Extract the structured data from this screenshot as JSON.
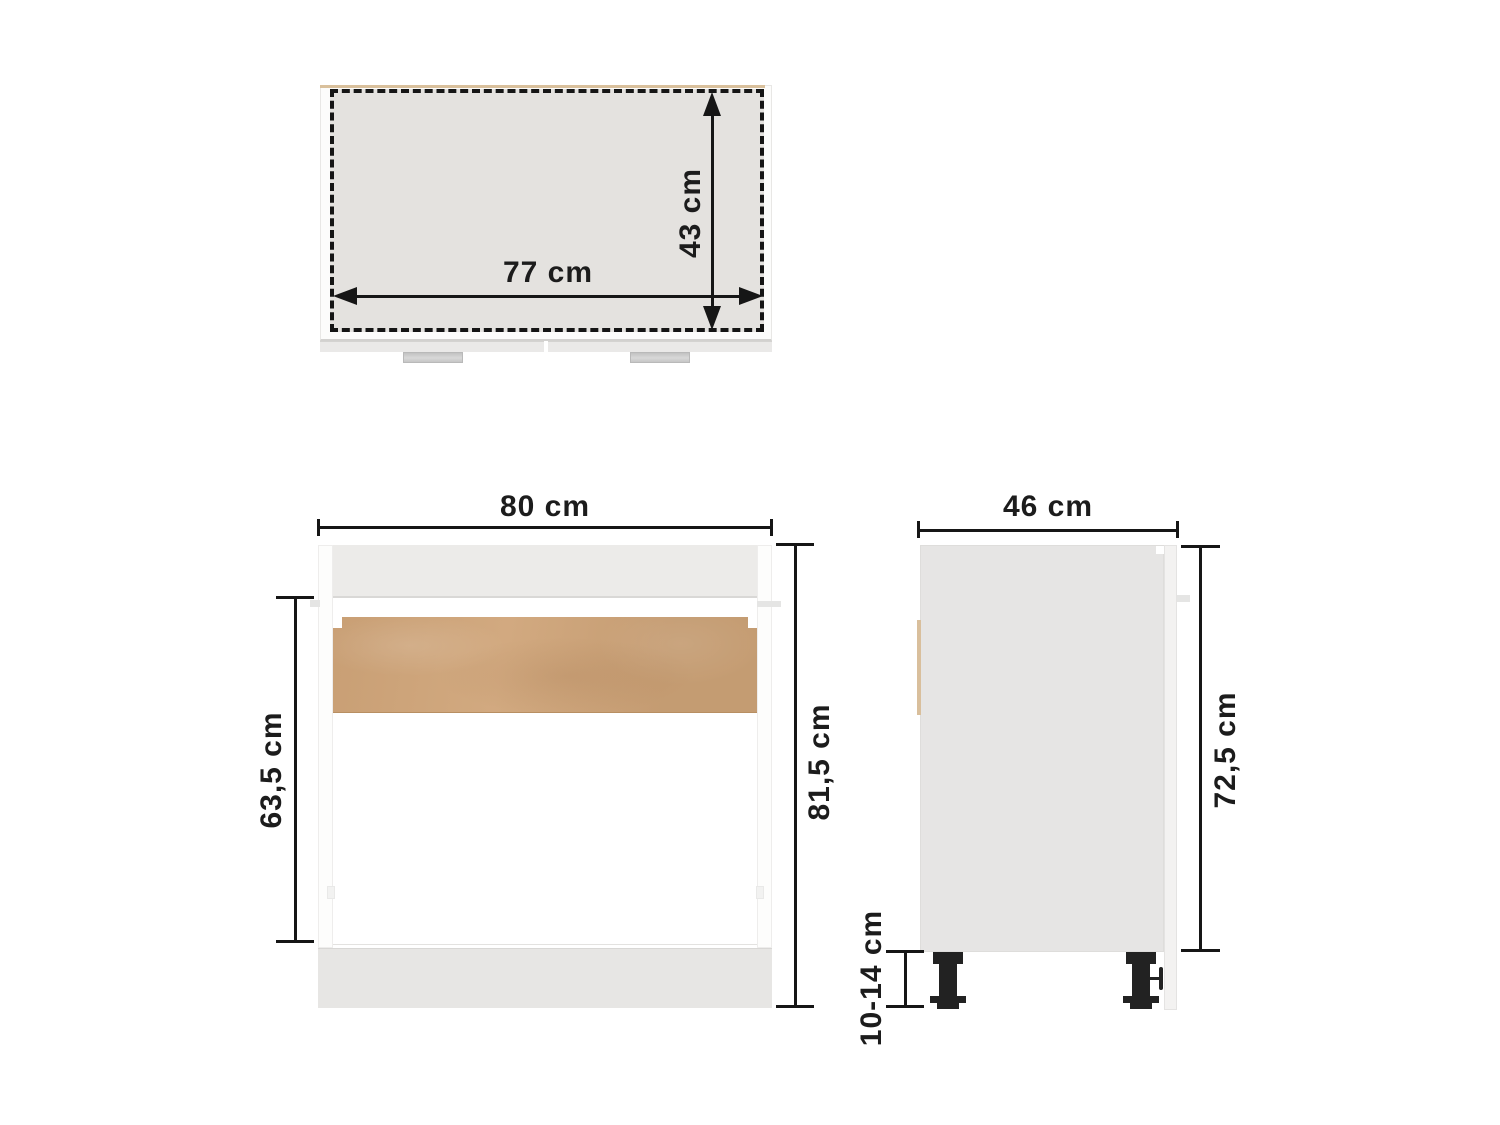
{
  "colors": {
    "background": "#ffffff",
    "dimension_ink": "#161616",
    "countertop_fill": "#e4e2df",
    "cabinet_gray": "#e6e5e4",
    "rail_gray": "#ecebe9",
    "plinth_gray": "#e7e6e4",
    "wood_panel": "#cfa478",
    "wood_edge": "#d9bf9c",
    "handle_gray": "#c9c9c9",
    "leg_black": "#222222"
  },
  "top_view": {
    "width": {
      "label": "77 cm"
    },
    "depth": {
      "label": "43 cm"
    }
  },
  "front_view": {
    "width": {
      "label": "80 cm"
    },
    "opening_height": {
      "label": "63,5 cm"
    },
    "total_height": {
      "label": "81,5 cm"
    }
  },
  "side_view": {
    "depth": {
      "label": "46 cm"
    },
    "body_height": {
      "label": "72,5 cm"
    },
    "leg_height": {
      "label": "10-14 cm"
    }
  }
}
